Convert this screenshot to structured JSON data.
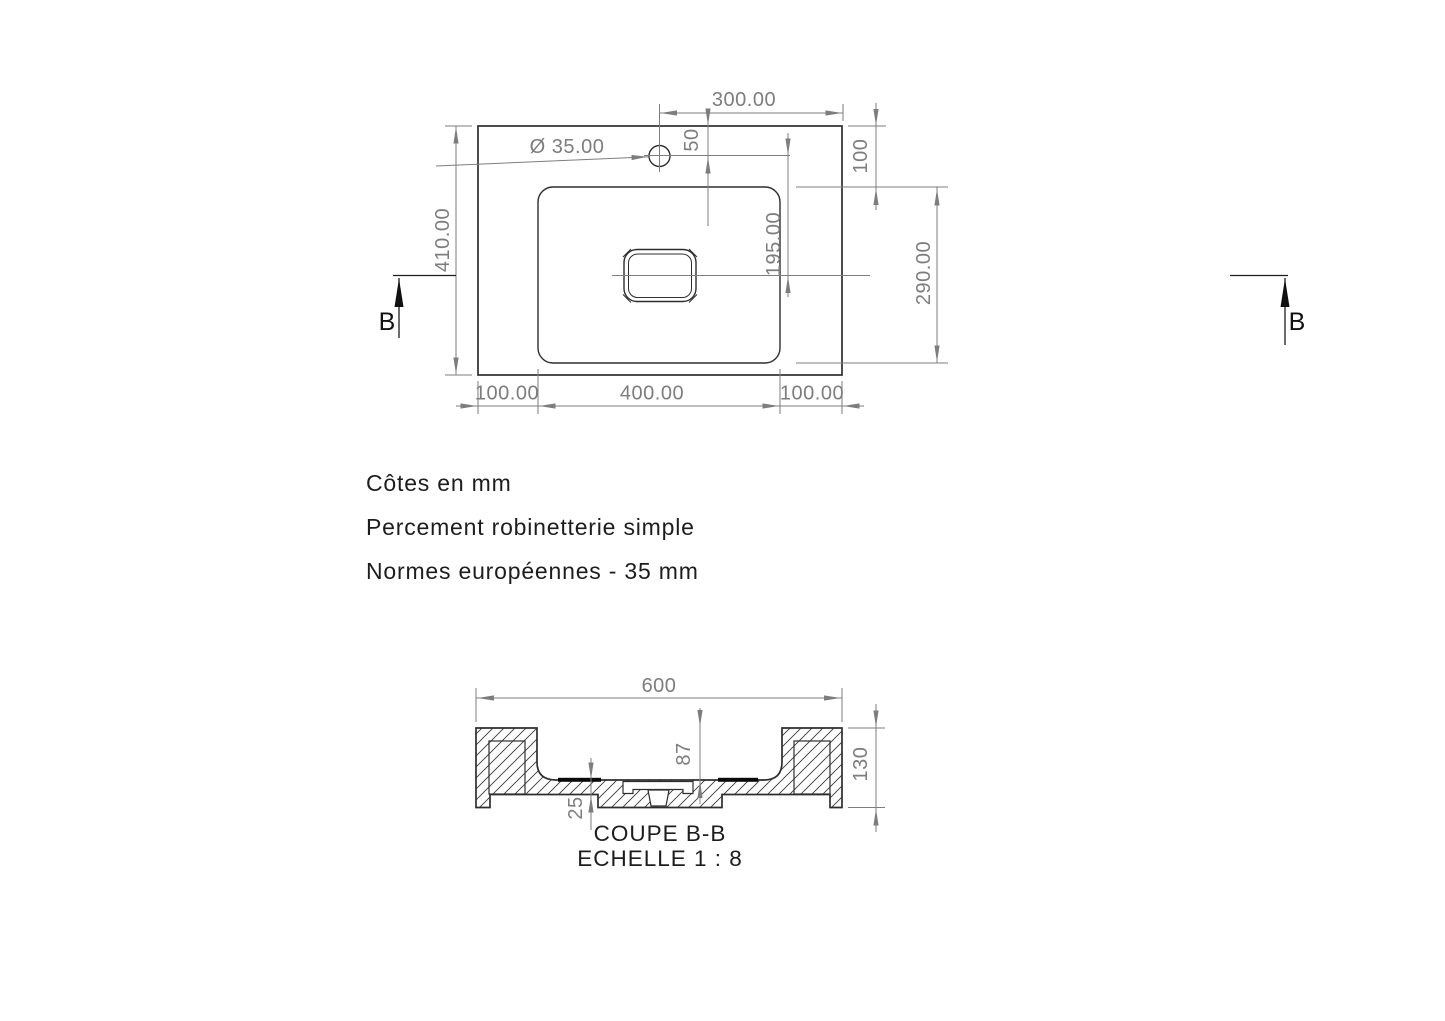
{
  "notes": {
    "units": "Côtes en mm",
    "drilling": "Percement robinetterie simple",
    "standard": "Normes européennes  - 35 mm"
  },
  "top_view": {
    "dims": {
      "total_height": "410.00",
      "hole_from_right_edge": "300.00",
      "hole_diameter": "Ø 35.00",
      "hole_from_top_edge": "50",
      "rim_right": "100",
      "basin_length": "290.00",
      "hole_to_drain": "195.00",
      "margin_left": "100.00",
      "basin_width": "400.00",
      "margin_right": "100.00"
    }
  },
  "section_view": {
    "title": "COUPE B-B",
    "scale": "ECHELLE 1 : 8",
    "dims": {
      "total_width": "600",
      "basin_depth": "87",
      "total_height": "130",
      "bottom_thickness": "25"
    }
  },
  "section_marks": {
    "left": "B",
    "right": "B"
  }
}
